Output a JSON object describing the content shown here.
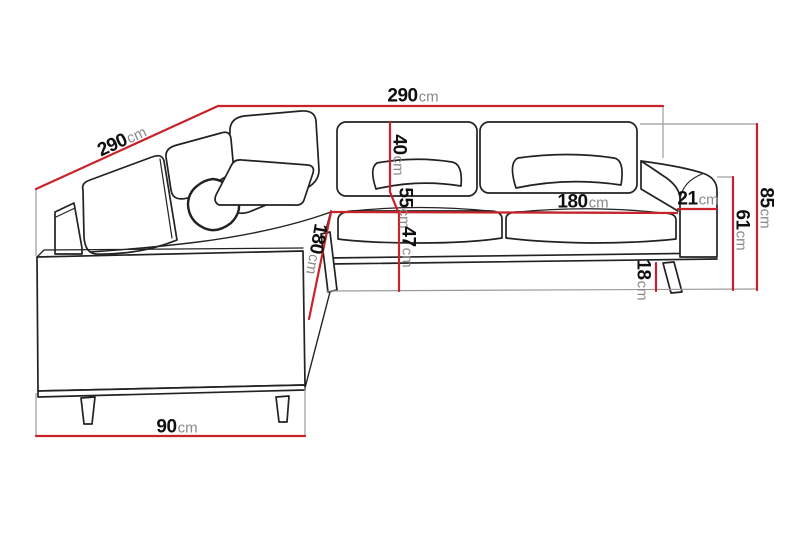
{
  "diagram": {
    "subject": "corner-sofa-dimension-drawing",
    "unit_default": "cm",
    "dimensions": [
      {
        "id": "width-top",
        "value": "290",
        "unit": "cm"
      },
      {
        "id": "depth-left",
        "value": "290",
        "unit": "cm"
      },
      {
        "id": "height-back",
        "value": "40",
        "unit": "cm"
      },
      {
        "id": "height-mid",
        "value": "55",
        "unit": "cm"
      },
      {
        "id": "height-seat",
        "value": "47",
        "unit": "cm"
      },
      {
        "id": "width-seat",
        "value": "180",
        "unit": "cm"
      },
      {
        "id": "length-chaise",
        "value": "180",
        "unit": "cm"
      },
      {
        "id": "width-armrest",
        "value": "21",
        "unit": "cm"
      },
      {
        "id": "height-total",
        "value": "85",
        "unit": "cm"
      },
      {
        "id": "height-armrest",
        "value": "61",
        "unit": "cm"
      },
      {
        "id": "height-leg",
        "value": "18",
        "unit": "cm"
      },
      {
        "id": "width-side",
        "value": "90",
        "unit": "cm"
      }
    ],
    "colors": {
      "dimension_line": "#c8232b",
      "sofa_outline": "#222222",
      "extension_line": "#9b9b9b",
      "number_text": "#101010",
      "unit_text": "#8a8a8a",
      "background": "#ffffff"
    }
  }
}
